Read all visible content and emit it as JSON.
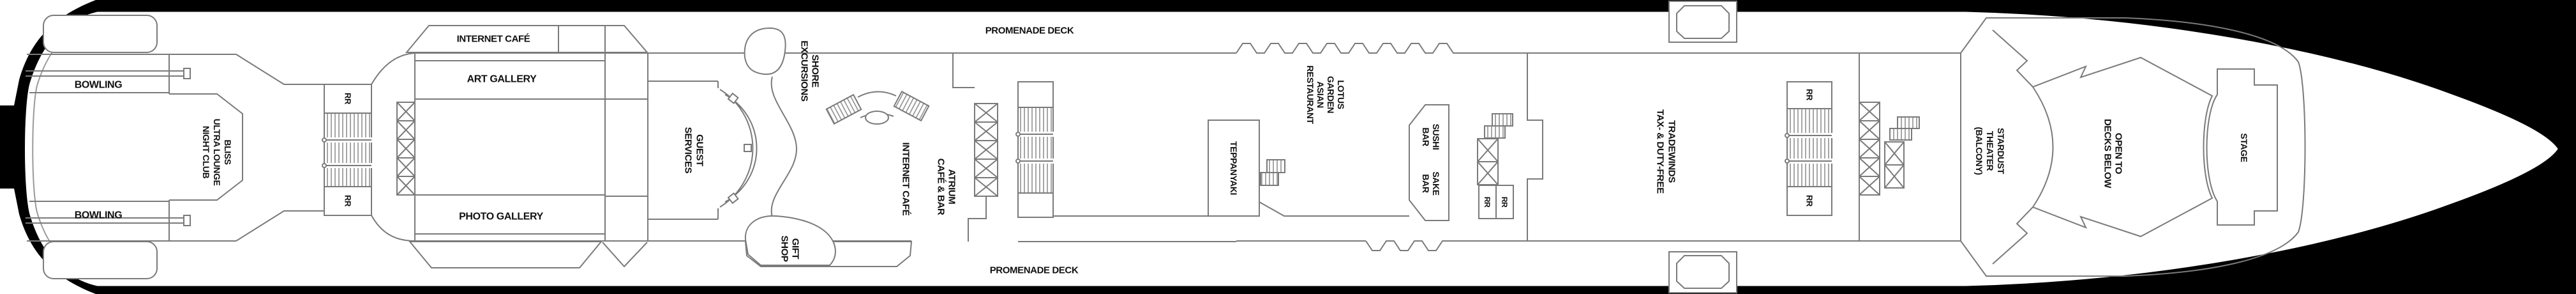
{
  "diagram": {
    "type": "cruise-ship-deck-plan",
    "colors": {
      "hull": "#000000",
      "walls": "#7a7a7a",
      "labels": "#111111",
      "background": "#ffffff"
    }
  },
  "labels": {
    "promenade_deck": "PROMENADE DECK",
    "bowling": "BOWLING",
    "restroom": "RR",
    "bliss": {
      "l1": "BLISS",
      "l2": "ULTRA LOUNGE",
      "l3": "NIGHT CLUB"
    },
    "internet_cafe": "INTERNET CAFÉ",
    "art_gallery": "ART GALLERY",
    "photo_gallery": "PHOTO GALLERY",
    "guest_services": {
      "l1": "GUEST",
      "l2": "SERVICES"
    },
    "shore_excursions": {
      "l1": "SHORE",
      "l2": "EXCURSIONS"
    },
    "gift_shop": {
      "l1": "GIFT",
      "l2": "SHOP"
    },
    "internet_cafe_atrium": "INTERNET CAFÉ",
    "atrium_cafe_bar": {
      "l1": "ATRIUM",
      "l2": "CAFÉ & BAR"
    },
    "lotus_garden": {
      "l1": "LOTUS",
      "l2": "GARDEN",
      "l3": "ASIAN",
      "l4": "RESTAURANT"
    },
    "teppanyaki": "TEPPANYAKI",
    "sushi_bar": {
      "l1": "SUSHI",
      "l2": "BAR"
    },
    "sake_bar": {
      "l1": "SAKE",
      "l2": "BAR"
    },
    "tradewinds": {
      "l1": "TRADEWINDS",
      "l2": "TAX- & DUTY-FREE"
    },
    "stardust_theater": {
      "l1": "STARDUST",
      "l2": "THEATER",
      "l3": "(BALCONY)"
    },
    "open_to_decks_below": {
      "l1": "OPEN TO",
      "l2": "DECKS BELOW"
    },
    "stage": "STAGE"
  }
}
